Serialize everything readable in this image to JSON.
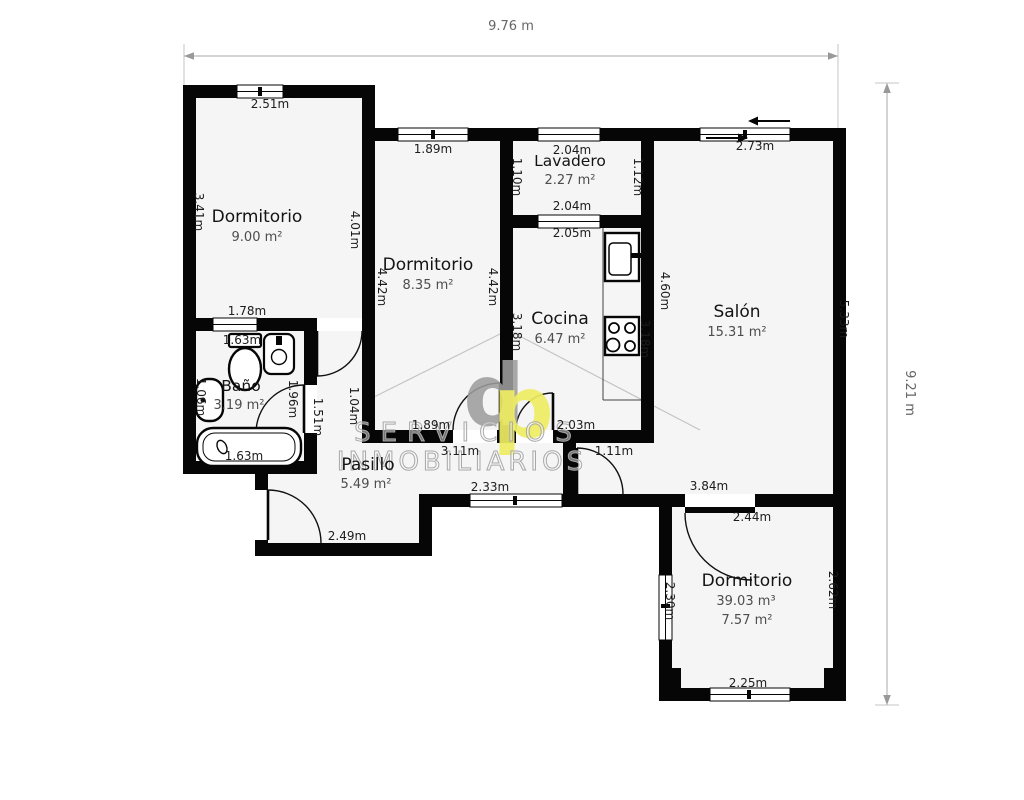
{
  "plan": {
    "overall_width": "9.76 m",
    "overall_height": "9.21 m"
  },
  "rooms": {
    "dormitorio1": {
      "name": "Dormitorio",
      "area": "9.00 m²"
    },
    "dormitorio2": {
      "name": "Dormitorio",
      "area": "8.35 m²"
    },
    "lavadero": {
      "name": "Lavadero",
      "area": "2.27 m²"
    },
    "cocina": {
      "name": "Cocina",
      "area": "6.47 m²"
    },
    "salon": {
      "name": "Salón",
      "area": "15.31 m²"
    },
    "bano": {
      "name": "Baño",
      "area": "3.19 m²"
    },
    "pasillo": {
      "name": "Pasillo",
      "area": "5.49 m²"
    },
    "dormitorio3": {
      "name": "Dormitorio",
      "volume": "39.03 m³",
      "area": "7.57 m²"
    }
  },
  "dimensions": {
    "dorm1_top": "2.51m",
    "dorm1_left": "3.41m",
    "dorm1_right": "4.01m",
    "dorm2_top": "1.89m",
    "dorm2_left": "4.42m",
    "dorm2_right": "4.42m",
    "dorm2_bottom": "1.89m",
    "lavadero_top": "2.04m",
    "lavadero_left": "1.10m",
    "lavadero_right": "1.12m",
    "lavadero_bottom": "2.04m",
    "cocina_top": "2.05m",
    "cocina_left": "3.18m",
    "cocina_right": "3.18m",
    "cocina_bottom": "2.03m",
    "salon_top": "2.73m",
    "salon_left": "4.60m",
    "salon_right": "5.33m",
    "bano_top": "1.78m",
    "bano_top_inner": "1.63m",
    "bano_left": "1.06m",
    "bano_right": "1.96m",
    "bano_tub": "1.63m",
    "pasillo_left": "1.51m",
    "pasillo_right": "1.04m",
    "pasillo_mid": "3.11m",
    "pasillo_window": "2.33m",
    "pasillo_bottom": "2.49m",
    "hall_door": "1.11m",
    "hall_right": "3.84m",
    "dorm3_top": "2.44m",
    "dorm3_left": "2.30m",
    "dorm3_right": "2.62m",
    "dorm3_bottom": "2.25m"
  },
  "watermark": {
    "letter_d": "d",
    "letter_p": "p",
    "line1": "SERVICIOS",
    "line2": "INMOBILIARIOS"
  },
  "colors": {
    "wall": "#060606",
    "floor": "#f5f5f5",
    "watermark_gray": "#9e9e9e",
    "watermark_yellow": "#efed62",
    "dimension_line": "#aaaaaa"
  }
}
